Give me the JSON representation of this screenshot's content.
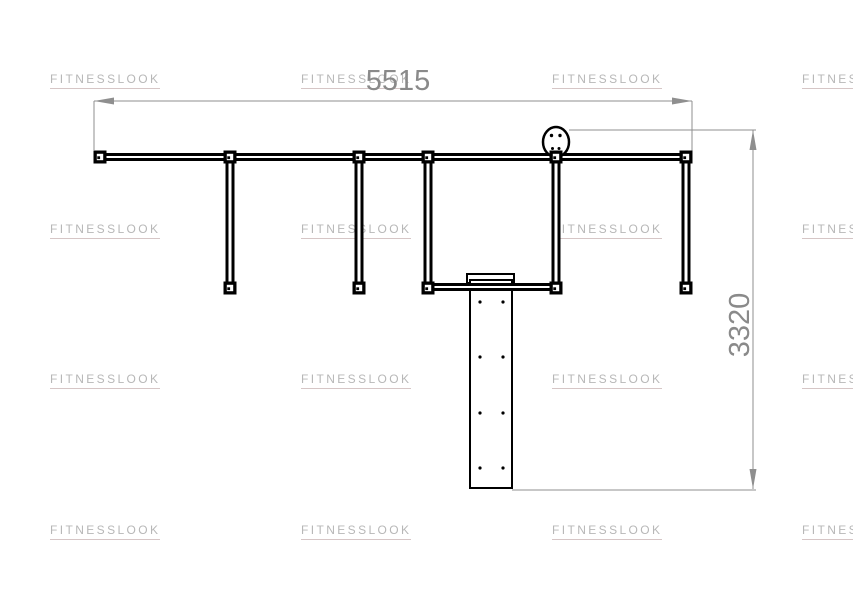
{
  "watermark": {
    "text": "FITNESSLOOK",
    "color": "#b7b7b7",
    "underline_color": "#d6c6c6",
    "columns_x": [
      50,
      301,
      552,
      802
    ],
    "rows_y": [
      72,
      222,
      372,
      523
    ]
  },
  "dimensions": {
    "width": {
      "label": "5515"
    },
    "height": {
      "label": "3320"
    }
  },
  "colors": {
    "line": "#000000",
    "dimension": "#8f8f8f",
    "dimension_text": "#8a8a8a",
    "background": "#ffffff"
  },
  "figure": {
    "beams": [
      {
        "name": "top-crossbeam",
        "x1": 95,
        "x2": 691,
        "y": 157
      },
      {
        "name": "lower-crossbeam",
        "x1": 424,
        "x2": 560,
        "y": 287
      }
    ],
    "beam_line_stroke": 3,
    "beam_half_gap": 2.5,
    "posts": {
      "xs": [
        230,
        359,
        428,
        556,
        686
      ],
      "y1": 157,
      "y2": 288,
      "half_gap": 3
    },
    "nodes": {
      "size": 13,
      "positions": [
        [
          100,
          157
        ],
        [
          230,
          157
        ],
        [
          359,
          157
        ],
        [
          428,
          157
        ],
        [
          556,
          157
        ],
        [
          686,
          157
        ],
        [
          230,
          288
        ],
        [
          359,
          288
        ],
        [
          428,
          288
        ],
        [
          556,
          288
        ],
        [
          686,
          288
        ]
      ]
    },
    "board": {
      "lip": {
        "x": 467,
        "y": 274,
        "w": 47,
        "h": 9
      },
      "body": {
        "x": 470,
        "y": 280,
        "w": 42,
        "h": 208
      },
      "dot_cols": [
        480,
        503
      ],
      "dot_rows": [
        302,
        357,
        413,
        468
      ],
      "dot_r": 1.6
    },
    "head": {
      "cx": 556,
      "cy": 142,
      "rx": 13,
      "ry": 15,
      "eyes": [
        [
          551.5,
          135.5
        ],
        [
          560,
          135.5
        ]
      ],
      "mouth": [
        [
          552.5,
          148.5
        ],
        [
          559,
          148.5
        ]
      ],
      "eye_r": 1.7
    },
    "dims": {
      "h": {
        "y": 101,
        "x1": 94,
        "x2": 692,
        "ext": [
          [
            94,
            101,
            150
          ],
          [
            692,
            101,
            156
          ]
        ]
      },
      "v": {
        "x": 753,
        "y1": 130,
        "y2": 489,
        "ext_top": [
          569,
          756,
          130
        ],
        "ext_bottom": [
          512,
          756,
          490
        ]
      }
    },
    "arrow": {
      "length": 20,
      "half_width": 3.5
    }
  }
}
